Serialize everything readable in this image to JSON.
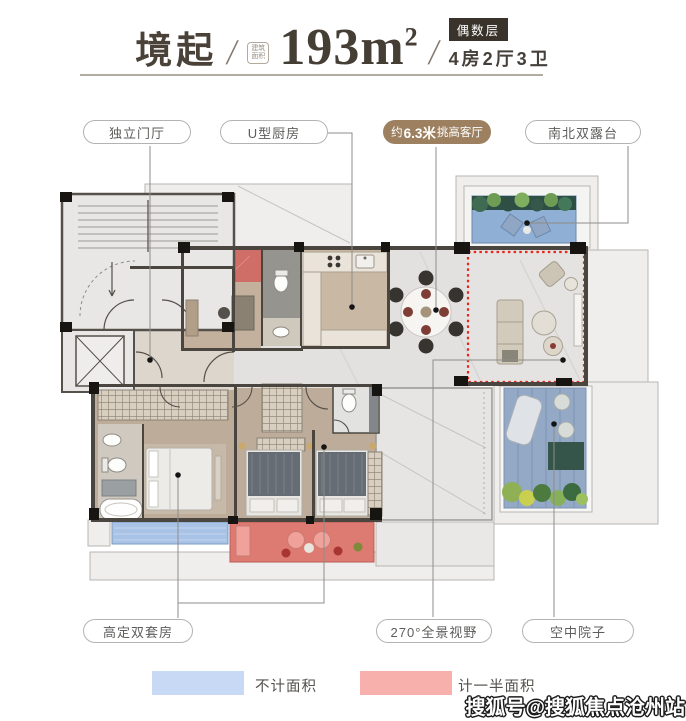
{
  "header": {
    "name": "境起",
    "slash": "/",
    "badge_line1": "建筑",
    "badge_line2": "面积",
    "area_value": "193m",
    "area_exp": "2",
    "floor_tag": "偶数层",
    "rooms": "4房2厅3卫"
  },
  "callouts": {
    "entry": "独立门厅",
    "kitchen": "U型厨房",
    "living_prefix": "约",
    "living_highlight": "6.3米",
    "living_suffix": "挑高客厅",
    "terrace": "南北双露台",
    "suites": "高定双套房",
    "view": "270°全景视野",
    "courtyard": "空中院子"
  },
  "legend": {
    "no_area": {
      "label": "不计面积",
      "color": "#c7d9f5"
    },
    "half_area": {
      "label": "计一半面积",
      "color": "#f8b0ad"
    }
  },
  "watermark": "搜狐号@搜狐焦点沧州站",
  "colors": {
    "accent_brown": "#9c8060",
    "tag_dark": "#3a332b",
    "dashed_red": "#e8241c",
    "balcony_red": "#dd7a72",
    "bay_blue": "#a9c3e6",
    "terrace_blue": "#8fb0d4"
  }
}
